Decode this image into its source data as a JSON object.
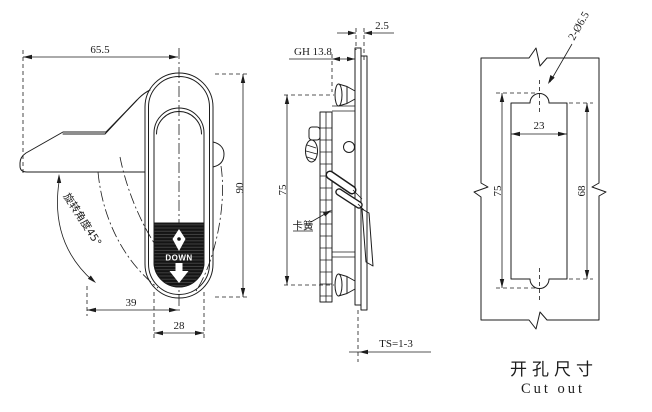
{
  "colors": {
    "line": "#1c1c1c",
    "background": "#ffffff",
    "grip_fill": "#141414"
  },
  "front_view": {
    "width_dim": "65.5",
    "height_dim": "90",
    "offset_dim": "39",
    "body_width_dim": "28",
    "rotation_note": "旋转角度45°",
    "grip_label": "DOWN"
  },
  "side_view": {
    "flange_dim": "2.5",
    "grip_height_dim": "GH 13.8",
    "mount_span_dim": "75",
    "thickness_dim": "TS=1-3",
    "clip_label": "卡簧"
  },
  "cutout_view": {
    "holes_dim": "2-Ø6.5",
    "width_dim": "23",
    "overall_height_dim": "75",
    "rect_height_dim": "68",
    "caption_cn": "开孔尺寸",
    "caption_en": "Cut out"
  }
}
